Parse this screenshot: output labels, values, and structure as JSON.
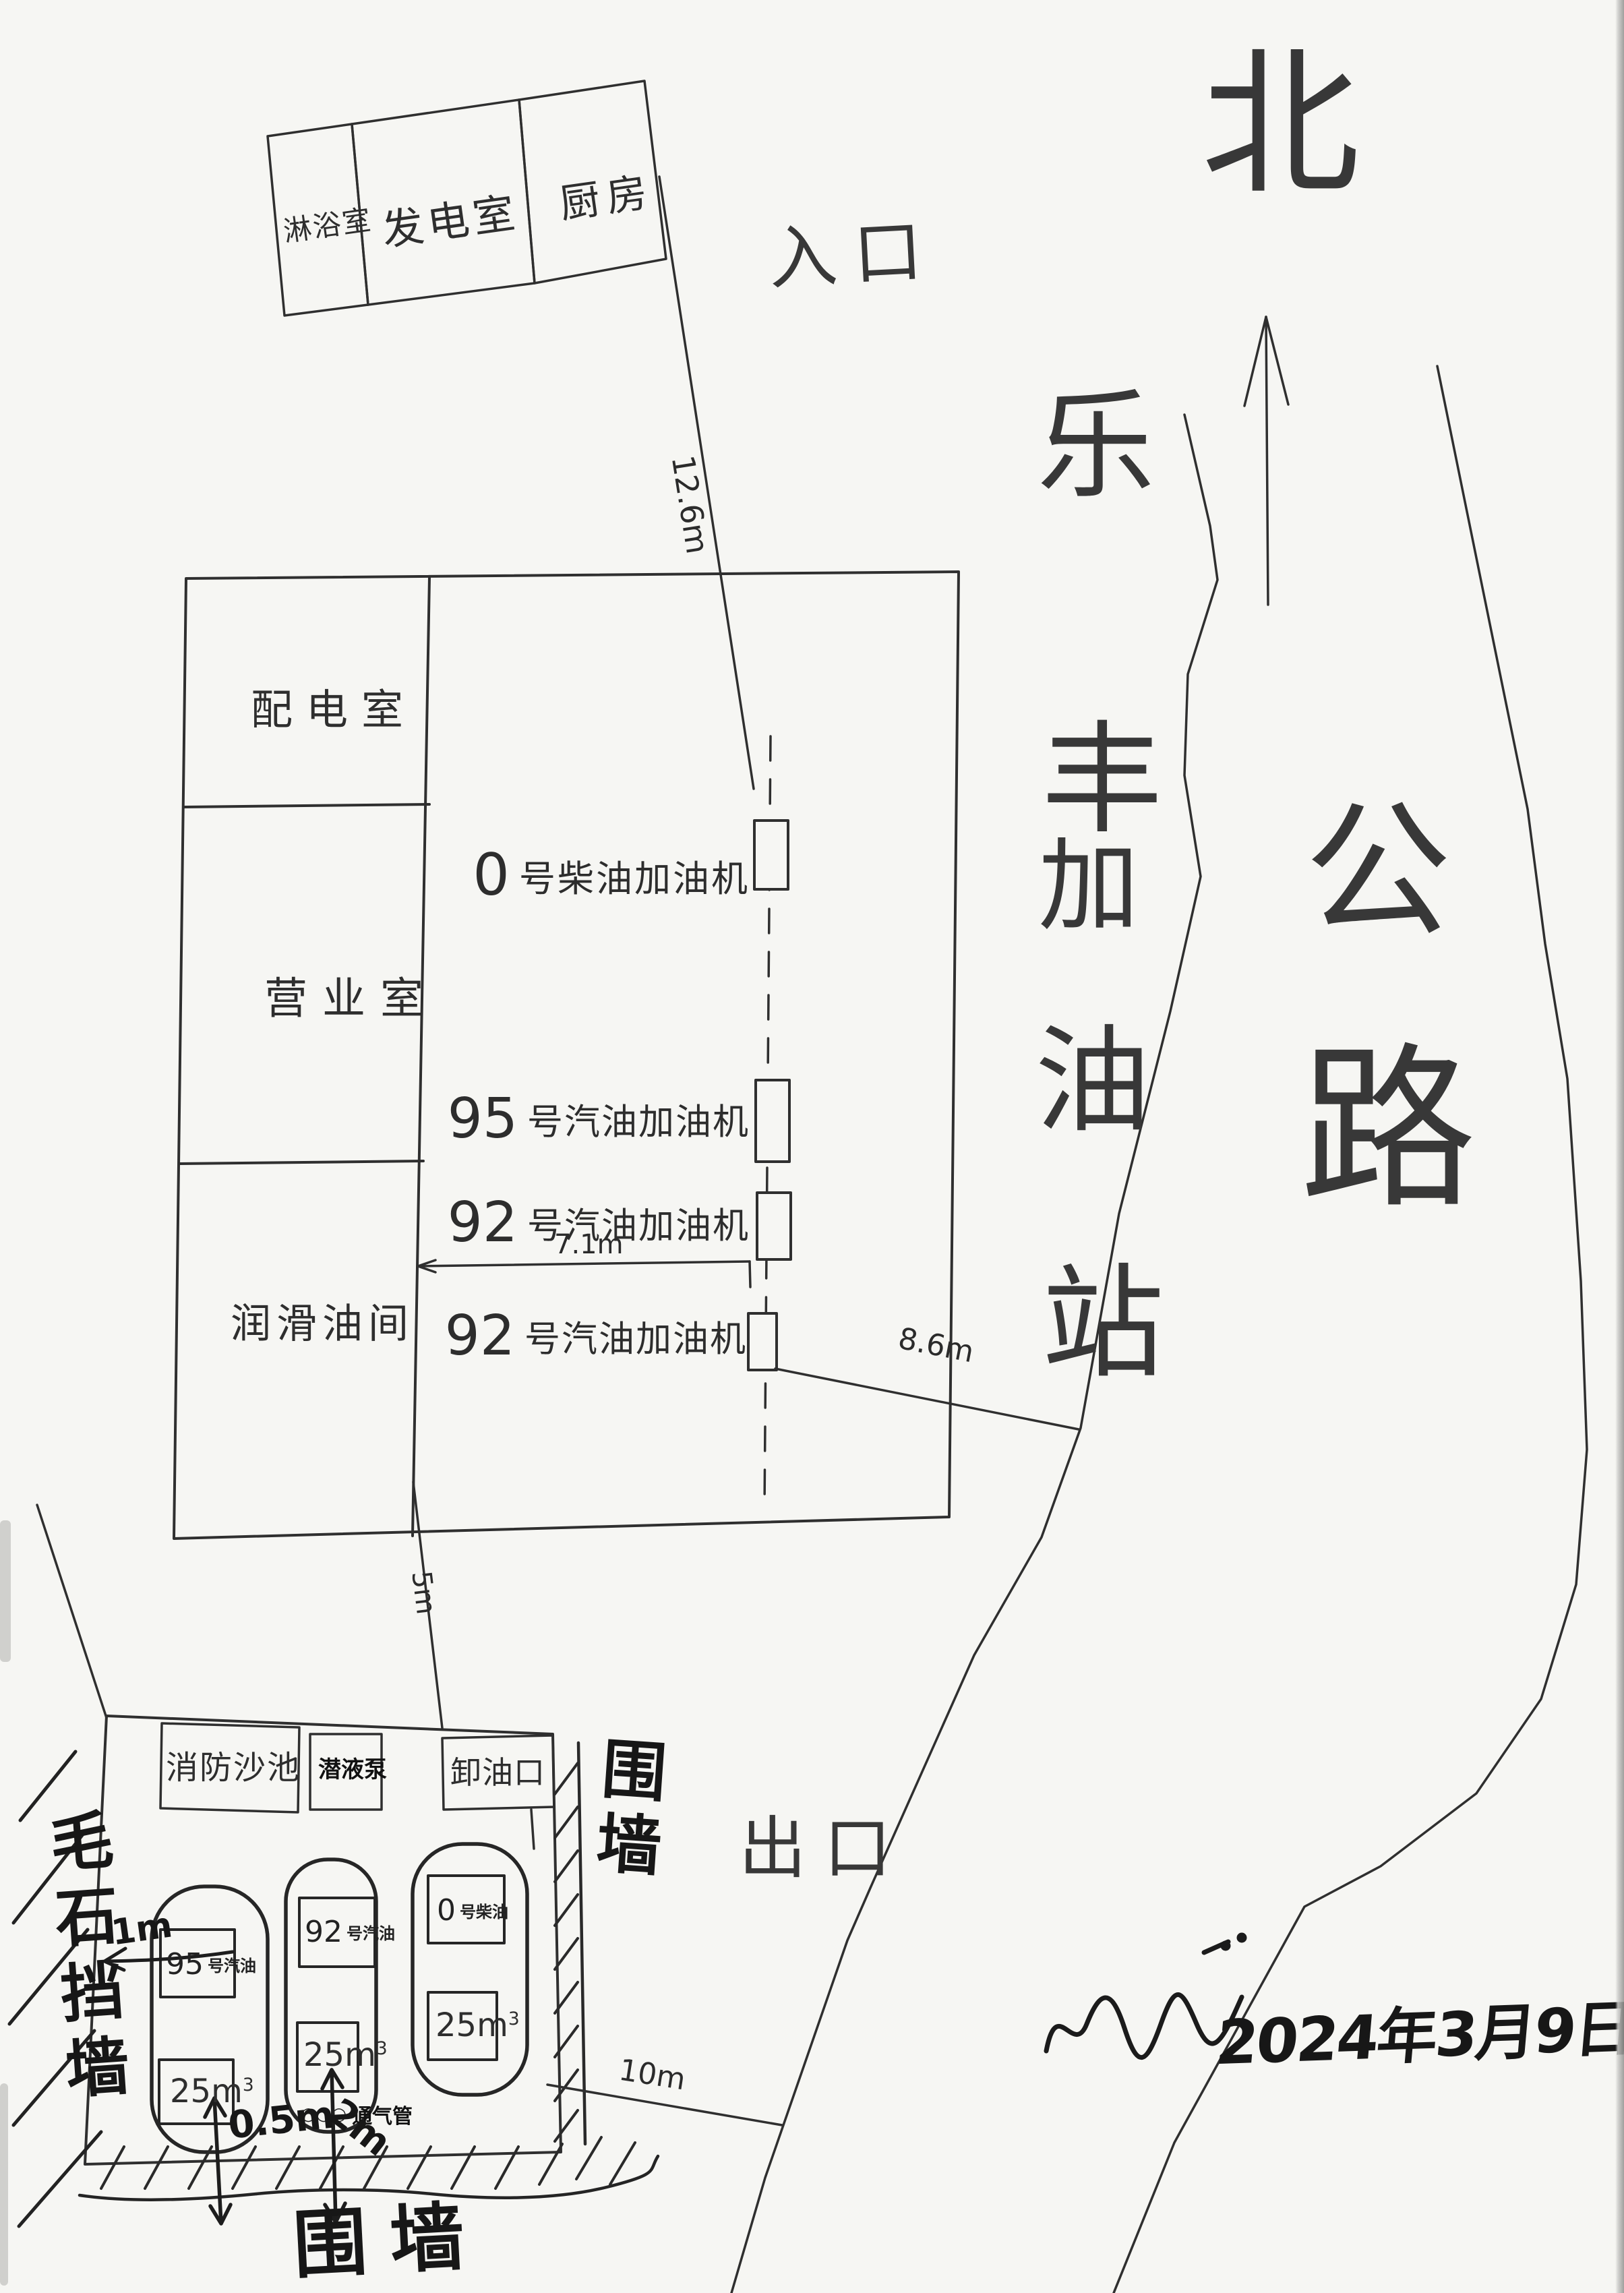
{
  "compass": {
    "north": "北"
  },
  "station": {
    "name_chars": [
      "乐",
      "丰",
      "加",
      "油",
      "站"
    ]
  },
  "road": {
    "label_chars": [
      "公",
      "路"
    ]
  },
  "gates": {
    "entrance": "入口",
    "exit": "出口"
  },
  "top_building": {
    "rooms": [
      "淋浴室",
      "发电室",
      "厨房"
    ]
  },
  "main_building": {
    "rooms": [
      "配电室",
      "营业室",
      "润滑油间"
    ]
  },
  "dispensers": [
    {
      "num": "0",
      "suffix": "号柴油加油机"
    },
    {
      "num": "95",
      "suffix": "号汽油加油机"
    },
    {
      "num": "92",
      "suffix": "号汽油加油机"
    },
    {
      "num": "92",
      "suffix": "号汽油加油机"
    }
  ],
  "dimensions": {
    "entrance_to_dispenser": "12.6m",
    "island": "7.1m",
    "dispenser_to_road": "8.6m",
    "building_to_tank_area": "5m",
    "tank_area_to_road": "10m",
    "tank_to_retaining_wall": "1m",
    "tank_to_fence": "0.5m",
    "vent_to_fence": "2m"
  },
  "tank_area": {
    "fire_sand_pool": "消防沙池",
    "pump_box": "潜液泵",
    "unloading_port": "卸油口",
    "tanks": [
      {
        "num": "95",
        "suffix": "号汽油",
        "volume": "25m",
        "volume_sup": "3"
      },
      {
        "num": "92",
        "suffix": "号汽油",
        "volume": "25m",
        "volume_sup": "3"
      },
      {
        "num": "0",
        "suffix": "号柴油",
        "volume": "25m",
        "volume_sup": "3"
      }
    ],
    "vent_circles": "○○○",
    "vent_label": "通气管",
    "retaining_wall": "毛石挡墙",
    "right_wall": "围墙",
    "bottom_wall": "围墙"
  },
  "footer": {
    "date": "2024年3月9日"
  }
}
